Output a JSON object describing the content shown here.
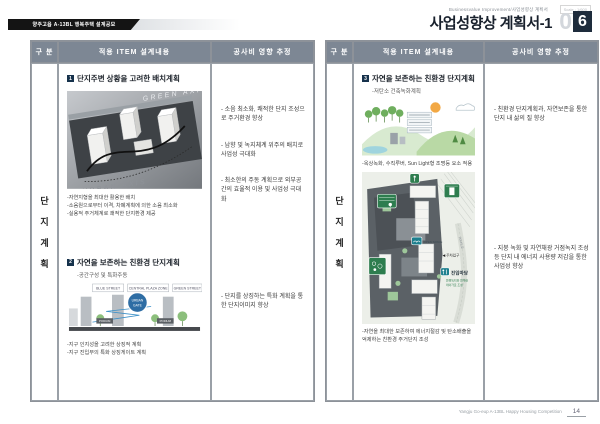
{
  "page": {
    "banner": "양주고읍 A-13BL 행복주택 설계공모",
    "eyebrow": "Businessvalue Improvement/사업성향상 계획서",
    "scale_note": "Scale : 1/600",
    "title": "사업성향상 계획서-1",
    "page_num_light": "0",
    "page_num_dark": "6",
    "footer": "Yangju Go-eup A-13BL Happy Housing Competition",
    "footer_page": "14"
  },
  "table_headers": {
    "col_category": "구 분",
    "col_item": "적용 ITEM 설계내용",
    "col_cost": "공사비 영향 추정"
  },
  "category": {
    "c0": "단",
    "c1": "지",
    "c2": "계",
    "c3": "획"
  },
  "left_panel": {
    "item1": {
      "num": "1",
      "title": "단지주변 상황을 고려한 배치계획",
      "axis_top": "GREEN AXIS",
      "axis_bottom": "URBAN AXIS",
      "bullets": [
        "-자연지형을 최대한 활용한 배치",
        "-소음원으로부터 이격, 차폐계획에 의한 소음 최소화",
        "-실용적 주거체계로 쾌적한 단지환경 제공"
      ]
    },
    "item2": {
      "num": "2",
      "title": "자연을 보존하는 친환경 단지계획",
      "subtitle": "-공간구성 및 특화주동",
      "tabs": [
        "BLUE STREET",
        "CENTRAL PLAZA ZONE",
        "GREEN STREET"
      ],
      "badge_line1": "URBAN",
      "badge_line2": "GATE",
      "podium": "PODIUM",
      "bullets": [
        "-지구 인지성을 고려한 상징적 계획",
        "-지구 진입부의 특화 상징게이트 계획"
      ]
    },
    "cost_top": [
      "- 소음 최소화, 쾌적한 단지 조성으로 주거환경 향상",
      "- 남향 및 녹지체계 위주의 배치로 사업성 극대화",
      "- 최소한의 주동 계획으로 외부공간의 효율적 이용 및 사업성 극대화"
    ],
    "cost_bottom": "- 단지를 상징하는 특화 계획을 통한 단지이미지 향상"
  },
  "right_panel": {
    "item": {
      "num": "3",
      "title": "자연을 보존하는 친환경 단지계획",
      "subtitle": "-저탄소 건축녹화계획",
      "eco_bullet": "-옥상녹화, 수직루버, Sun Light형 조명등 요소 적용",
      "plan": {
        "entry_label": "진입마당",
        "entry_note1": "연결녹지와 연계한",
        "entry_note2": "테마가로 조성",
        "parking_label": "◀ 주차입구",
        "road_label": "20M도로",
        "open_space": "OPEN SPACE"
      },
      "bottom_bullet": "-자연을 최대한 보존하여 에너지절감 및 탄소배출을 억제하는 친환경 주거단지 조성"
    },
    "cost_top": "- 친환경 단지계획과, 자연보존을 통한 단지 내 삶의 질 향상",
    "cost_bottom": "- 지붕 녹화 및 자연채광 거점녹지 조성 등 단지 내 에너지 사용량 저감을 통한 사업성 향상"
  }
}
